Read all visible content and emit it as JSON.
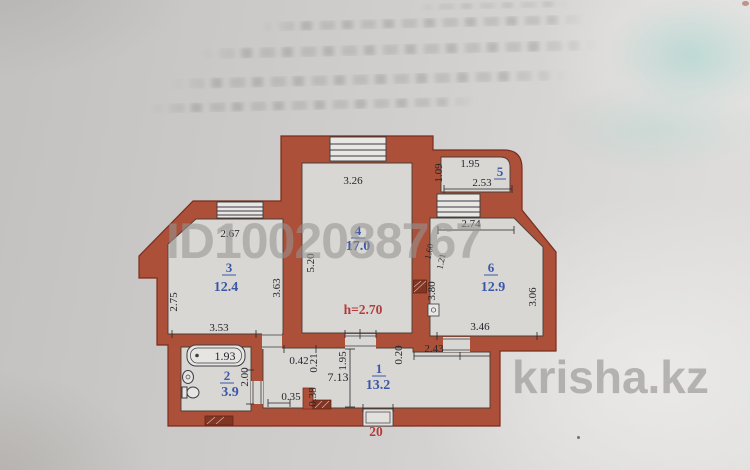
{
  "watermarks": {
    "listing_id": "ID1002088767",
    "site": "krisha.kz"
  },
  "plan": {
    "apartment_number": "20",
    "note_ceiling_height": "h=2.70",
    "rooms": {
      "r1": {
        "number": "1",
        "area": "13.2"
      },
      "r2": {
        "number": "2",
        "area": "3.9"
      },
      "r3": {
        "number": "3",
        "area": "12.4"
      },
      "r4": {
        "number": "4",
        "area": "17.0"
      },
      "r5": {
        "number": "5"
      },
      "r6": {
        "number": "6",
        "area": "12.9"
      }
    },
    "dims": {
      "r3": {
        "top": "2.67",
        "left": "2.75",
        "right": "3.63",
        "bottom": "3.53"
      },
      "r4": {
        "top": "3.26",
        "left": "5.20"
      },
      "r5": {
        "left": "1.09",
        "top": "1.95",
        "width": "2.53"
      },
      "r6": {
        "top": "2.74",
        "left": "3.80",
        "right": "3.06",
        "bottom": "3.46",
        "niche_a": "1.60",
        "niche_b": "1.21"
      },
      "bath": {
        "tub": "1.93",
        "depth": "2.00"
      },
      "hall": {
        "length": "7.13",
        "seg_a": "0.42",
        "wall_a": "0.21",
        "width": "1.95",
        "wall_b": "0.20",
        "seg_b": "2.43",
        "seg_c": "0.35",
        "wall_c": "0.38"
      }
    },
    "colors": {
      "wall": "#ac5039",
      "room_label_blue": "#3b57a9",
      "note_red": "#b23b3d",
      "dimension_text": "#26262c"
    }
  }
}
